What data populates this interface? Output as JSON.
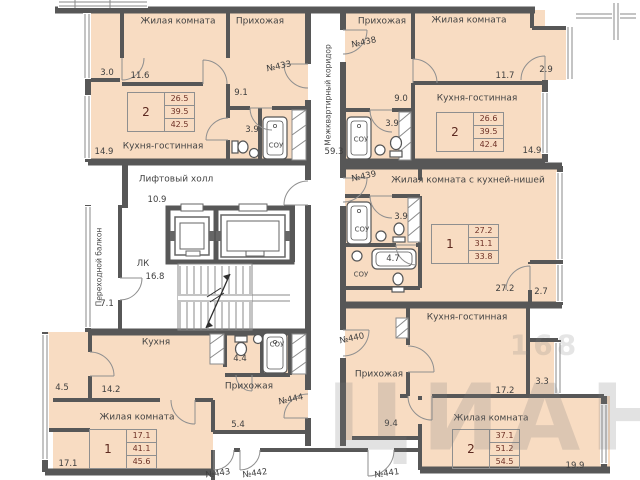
{
  "watermark": {
    "brand": "ЦИАН",
    "digits": "168"
  },
  "common_areas": {
    "inter_apartment_corridor": {
      "label": "Межквартирный коридор",
      "area": "59.3"
    },
    "lift_hall": {
      "label": "Лифтовый холл",
      "area": "10.9"
    },
    "stairwell": {
      "label": "ЛК",
      "area": "16.8"
    },
    "transfer_balcony": {
      "label": "Переходной балкон",
      "area": "7.1"
    }
  },
  "apartments": {
    "a433": {
      "number": "№433",
      "rooms": "2",
      "area_living": "26.5",
      "area_heated": "39.5",
      "area_total": "42.5",
      "living_room_label": "Жилая комната",
      "living_room_area": "11.6",
      "hall_label": "Прихожая",
      "hall_area": "9.1",
      "kitchen_label": "Кухня-гостинная",
      "kitchen_area": "14.9",
      "bath_label": "СОУ",
      "bath_area": "3.9",
      "balcony_area": "3.0"
    },
    "a438": {
      "number": "№438",
      "rooms": "2",
      "area_living": "26.6",
      "area_heated": "39.5",
      "area_total": "42.4",
      "living_room_label": "Жилая комната",
      "living_room_area": "11.7",
      "hall_label": "Прихожая",
      "hall_area": "9.0",
      "kitchen_label": "Кухня-гостинная",
      "kitchen_area": "14.9",
      "bath_label": "СОУ",
      "bath_area": "3.9",
      "balcony_area": "2.9"
    },
    "a439": {
      "number": "№439",
      "rooms": "1",
      "area_living": "27.2",
      "area_heated": "31.1",
      "area_total": "33.8",
      "main_room_label": "Жилая комната с кухней-нишей",
      "main_room_area": "27.2",
      "bath1_label": "СОУ",
      "bath1_area": "3.9",
      "bath2_label": "СОУ",
      "bath2_area": "4.7",
      "balcony_area": "2.7"
    },
    "a440": {
      "number": "№440",
      "rooms": "2",
      "area_living": "37.1",
      "area_heated": "51.2",
      "area_total": "54.5",
      "kitchen_label": "Кухня-гостинная",
      "kitchen_area": "17.2",
      "hall_label": "Прихожая",
      "hall_area": "9.4",
      "living_room_label": "Жилая комната",
      "living_room_area": "19.9",
      "balcony_area": "3.3"
    },
    "a444": {
      "number": "№444",
      "rooms": "1",
      "area_living": "17.1",
      "area_heated": "41.1",
      "area_total": "45.6",
      "kitchen_label": "Кухня",
      "kitchen_area": "14.2",
      "hall_label": "Прихожая",
      "hall_area": "5.4",
      "living_room_label": "Жилая комната",
      "living_room_area": "17.1",
      "bath_label": "СОУ",
      "wc_area": "4.4",
      "balcony_area": "4.5"
    }
  },
  "entry_doors": {
    "d443": "№443",
    "d442": "№442",
    "d441": "№441"
  },
  "colors": {
    "room_fill": "#f8dcc2",
    "wall": "#575757",
    "dimension_text": "#3e3e3e",
    "table_text": "#6e3126"
  }
}
